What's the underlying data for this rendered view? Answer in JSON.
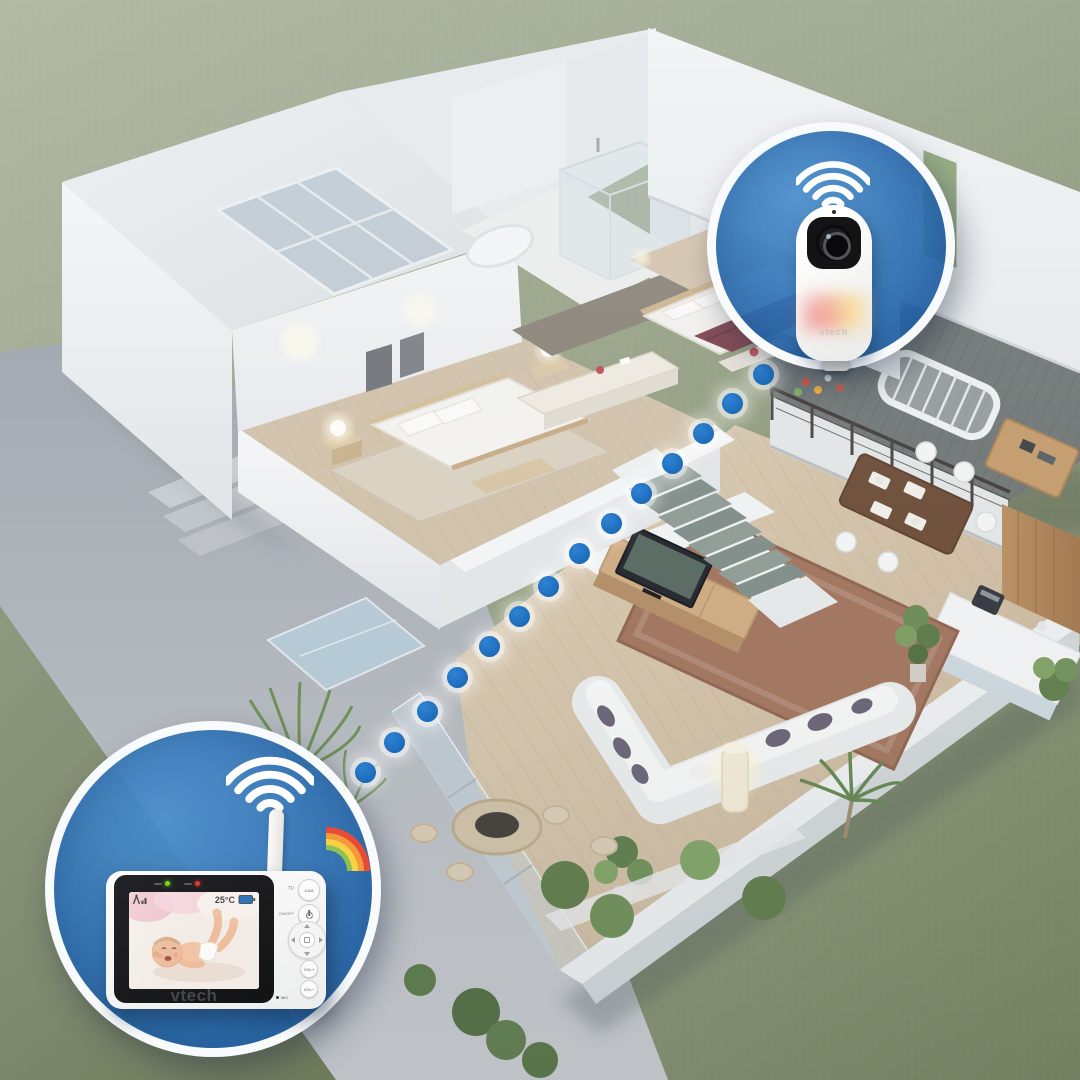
{
  "brand": {
    "name": "vtech"
  },
  "callouts": {
    "camera": {
      "wifi_icon": "wifi-signal-icon",
      "device_name": "baby-unit-camera",
      "brand_text": "vtech",
      "night_light_colors": [
        "#f0968e",
        "#f8d98e"
      ]
    },
    "monitor": {
      "wifi_icon": "wifi-signal-icon",
      "device_name": "parent-unit-monitor",
      "brand_text": "vtech",
      "screen": {
        "signal_icon": "antenna-signal-icon",
        "temperature": "25°C",
        "battery_icon": "battery-icon"
      },
      "side_buttons": {
        "tv_label": "TV",
        "cam_button_label": "CAM",
        "power_label": "ON/OFF",
        "power_icon": "power-icon",
        "nav_pad_icon": "directional-pad-icon",
        "vol_up_label": "VOL+",
        "vol_down_label": "VOL−",
        "mic_label": "MIC"
      },
      "indicator_leds": [
        {
          "name": "power-led",
          "color": "#7ed321"
        },
        {
          "name": "alert-led",
          "color": "#e0392f"
        }
      ]
    }
  },
  "connection_path": {
    "dot_count": 14,
    "dot_color": "#1d6cbb"
  },
  "palette": {
    "callout_blue": "#2e74bb",
    "ring_white": "#ffffff",
    "grass_green": "#96a083",
    "floor_wood": "#d3c3ab",
    "deck_wood": "#6f7573",
    "bed_accent_maroon": "#7d3f4b"
  }
}
